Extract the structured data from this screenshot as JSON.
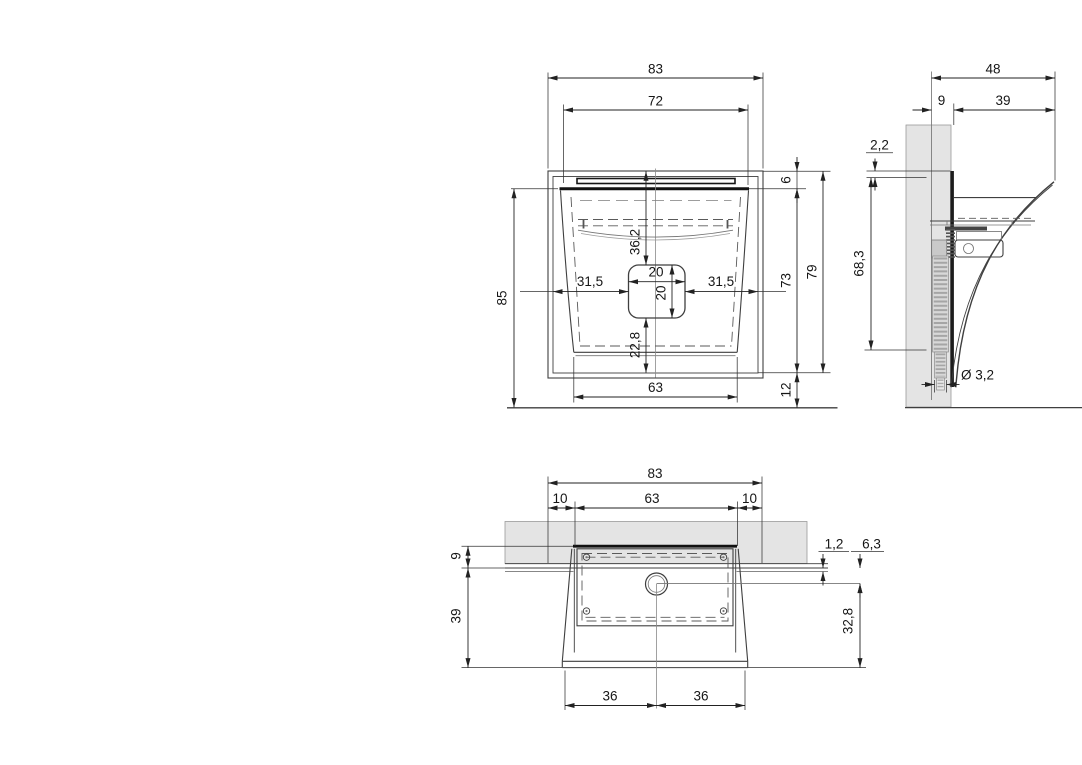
{
  "drawing_type": "technical-orthographic-views",
  "colors": {
    "background": "#ffffff",
    "line": "#3f3f3f",
    "dimension_text": "#161616",
    "wall_section_fill": "#e4e4e4"
  },
  "front": {
    "overall_width": "83",
    "top_width": "72",
    "overall_height": "85",
    "rim_offset": "6",
    "inner_height": "73",
    "body_height": "79",
    "base_offset": "12",
    "hole_offset_left": "31,5",
    "hole_offset_right": "31,5",
    "hole_top_offset": "36,2",
    "hole_width": "20",
    "hole_height": "20",
    "hole_bottom_offset": "22,8",
    "bottom_width": "63"
  },
  "side": {
    "overall_depth": "48",
    "wall_recess": "9",
    "front_depth": "39",
    "lip_thickness": "2,2",
    "back_height": "68,3",
    "hose_diameter": "Ø 3,2"
  },
  "bottom": {
    "overall_width": "83",
    "overlap_left": "10",
    "cutout_width": "63",
    "overlap_right": "10",
    "rim_depth": "9",
    "body_depth": "39",
    "plate_thickness": "1,2",
    "drain_center_offset": "6,3",
    "inner_depth": "32,8",
    "half_width_left": "36",
    "half_width_right": "36"
  }
}
